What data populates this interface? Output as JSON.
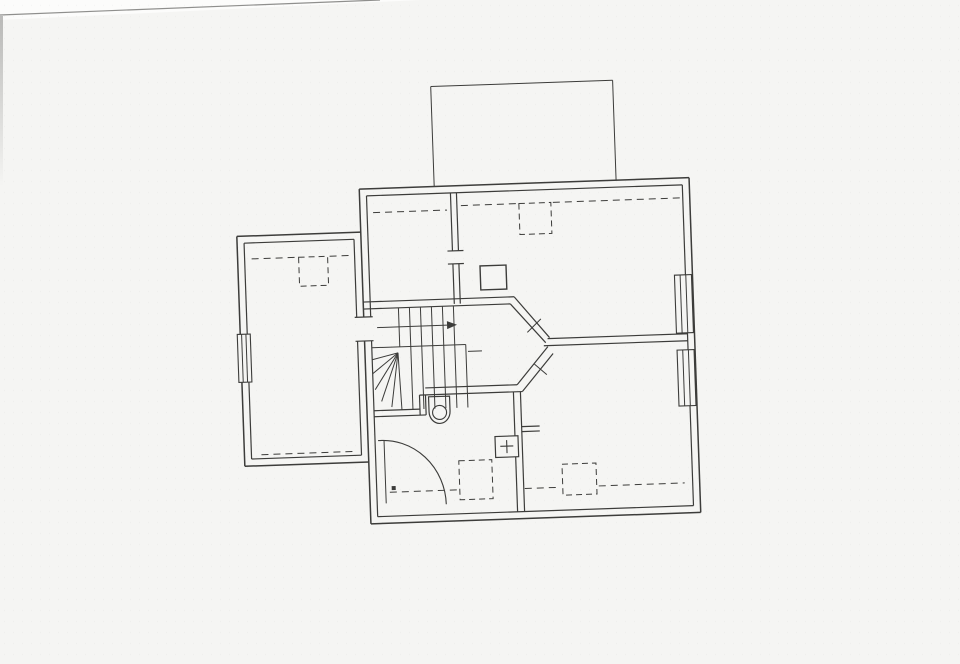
{
  "page": {
    "paper_color": "#f5f5f3",
    "scanner_bg_color": "#fcfcfb",
    "ink_color": "#3c3c3a",
    "text_color": "#2e2e2c",
    "paper_edge_line": [
      0,
      15,
      380,
      0
    ],
    "plan_rotation_deg": -2,
    "plan_rotation_center": [
      480,
      352
    ]
  },
  "plan": {
    "rooms": [
      {
        "number": "7",
        "area": "6.0",
        "x": 494,
        "y": 344
      },
      {
        "number": "8",
        "area": "13.4",
        "x": 590,
        "y": 425
      },
      {
        "number": "9",
        "area": "7.7",
        "x": 446,
        "y": 441
      },
      {
        "number": "10",
        "area": "16.0",
        "x": 311,
        "y": 346
      },
      {
        "number": "11",
        "area": "4.6",
        "x": 416,
        "y": 251
      },
      {
        "number": "12",
        "area": "16.5",
        "x": 578,
        "y": 262
      }
    ],
    "dimension_labels": [
      {
        "t": "0.19",
        "x": 380,
        "y": 207,
        "r": -90
      },
      {
        "t": "h=1.60",
        "x": 413,
        "y": 213,
        "r": 0
      },
      {
        "t": "2.37",
        "x": 387,
        "y": 250,
        "r": -90
      },
      {
        "t": "1.95",
        "x": 419,
        "y": 296,
        "r": 180
      },
      {
        "t": "0.19",
        "x": 461,
        "y": 204,
        "r": -90
      },
      {
        "t": "2.37",
        "x": 460,
        "y": 247,
        "r": -90
      },
      {
        "t": "h=1.60",
        "x": 574,
        "y": 211,
        "r": 0
      },
      {
        "t": "5.42",
        "x": 597,
        "y": 238,
        "r": 180
      },
      {
        "t": "0.19",
        "x": 671,
        "y": 206,
        "r": -75
      },
      {
        "t": "3.52",
        "x": 670,
        "y": 268,
        "r": -90
      },
      {
        "t": "0.57",
        "x": 490,
        "y": 259,
        "r": 180
      },
      {
        "t": "0.58",
        "x": 513,
        "y": 278,
        "r": -90
      },
      {
        "t": "1.45",
        "x": 482,
        "y": 295,
        "r": 180
      },
      {
        "t": "3.97",
        "x": 540,
        "y": 297,
        "r": 180
      },
      {
        "t": "3.45",
        "x": 501,
        "y": 310,
        "r": 180
      },
      {
        "t": "1.43",
        "x": 533,
        "y": 324,
        "r": 135
      },
      {
        "t": "2.30",
        "x": 468,
        "y": 340,
        "r": 180
      },
      {
        "t": "1.13",
        "x": 474,
        "y": 362,
        "r": -90
      },
      {
        "t": "4.40",
        "x": 513,
        "y": 349,
        "r": 135
      },
      {
        "t": "1.42",
        "x": 534,
        "y": 364,
        "r": -135
      },
      {
        "t": "1.48",
        "x": 545,
        "y": 374,
        "r": -135
      },
      {
        "t": "3.45",
        "x": 500,
        "y": 384,
        "r": 180
      },
      {
        "t": "3.02",
        "x": 611,
        "y": 338,
        "r": 180
      },
      {
        "t": "3.02",
        "x": 614,
        "y": 355,
        "r": 180
      },
      {
        "t": "0.90",
        "x": 521,
        "y": 408,
        "r": -90
      },
      {
        "t": "0.10",
        "x": 542,
        "y": 433,
        "r": -90
      },
      {
        "t": "0.62",
        "x": 526,
        "y": 439,
        "r": 180
      },
      {
        "t": "2.35",
        "x": 501,
        "y": 431,
        "r": -90
      },
      {
        "t": "3.97",
        "x": 566,
        "y": 408,
        "r": 180
      },
      {
        "t": "3.52",
        "x": 669,
        "y": 416,
        "r": -75
      },
      {
        "t": "h=1.60",
        "x": 607,
        "y": 484,
        "r": 0
      },
      {
        "t": "0.19",
        "x": 673,
        "y": 494,
        "r": -90
      },
      {
        "t": "0.39",
        "x": 413,
        "y": 401,
        "r": -90
      },
      {
        "t": "0.83",
        "x": 394,
        "y": 417,
        "r": 180
      },
      {
        "t": "3.40",
        "x": 419,
        "y": 432,
        "r": 180
      },
      {
        "t": "h=1.60",
        "x": 443,
        "y": 487,
        "r": 0
      },
      {
        "t": "0.19",
        "x": 498,
        "y": 491,
        "r": -90
      },
      {
        "t": "0.19",
        "x": 250,
        "y": 250,
        "r": -90
      },
      {
        "t": "h=1.60",
        "x": 281,
        "y": 250,
        "r": 180
      },
      {
        "t": "5.28",
        "x": 263,
        "y": 347,
        "r": -80
      },
      {
        "t": "3.03",
        "x": 334,
        "y": 421,
        "r": 180
      },
      {
        "t": "h=1.60",
        "x": 303,
        "y": 447,
        "r": 180
      },
      {
        "t": "0.10",
        "x": 257,
        "y": 446,
        "r": -90
      }
    ],
    "lines": {
      "heavy": [
        [
          365,
          185,
          695,
          185
        ],
        [
          695,
          185,
          695,
          520
        ],
        [
          365,
          520,
          695,
          520
        ],
        [
          365,
          185,
          365,
          313
        ],
        [
          365,
          337,
          365,
          520
        ],
        [
          241,
          228,
          365,
          228
        ],
        [
          241,
          228,
          241,
          326
        ],
        [
          241,
          374,
          241,
          458
        ],
        [
          241,
          458,
          365,
          458
        ]
      ],
      "normal": [
        [
          372,
          192,
          688,
          192
        ],
        [
          688,
          192,
          688,
          513
        ],
        [
          372,
          513,
          688,
          513
        ],
        [
          372,
          192,
          372,
          313
        ],
        [
          372,
          337,
          372,
          513
        ],
        [
          248,
          235,
          358,
          235
        ],
        [
          248,
          235,
          248,
          326
        ],
        [
          248,
          374,
          248,
          451
        ],
        [
          248,
          451,
          358,
          451
        ],
        [
          358,
          235,
          358,
          313
        ],
        [
          358,
          337,
          358,
          451
        ],
        [
          356,
          313,
          374,
          313
        ],
        [
          356,
          337,
          374,
          337
        ],
        [
          456,
          192,
          456,
          250
        ],
        [
          462,
          192,
          462,
          250
        ],
        [
          456,
          263,
          456,
          303
        ],
        [
          462,
          263,
          462,
          303
        ],
        [
          451,
          250,
          467,
          250
        ],
        [
          451,
          263,
          467,
          263
        ],
        [
          365,
          298,
          516,
          298
        ],
        [
          365,
          305,
          512,
          305
        ],
        [
          516,
          298,
          550,
          340
        ],
        [
          512,
          305,
          546,
          345
        ],
        [
          548,
          341,
          688,
          341
        ],
        [
          544,
          348,
          688,
          348
        ],
        [
          548,
          349,
          516,
          386
        ],
        [
          553,
          356,
          521,
          393
        ],
        [
          424,
          386,
          516,
          386
        ],
        [
          418,
          393,
          521,
          393
        ],
        [
          418,
          393,
          418,
          413
        ],
        [
          424,
          393,
          424,
          413
        ],
        [
          372,
          407,
          418,
          407
        ],
        [
          372,
          413,
          424,
          413
        ],
        [
          512,
          393,
          512,
          513
        ],
        [
          519,
          393,
          519,
          513
        ],
        [
          519,
          428,
          537,
          428
        ],
        [
          519,
          433,
          537,
          433
        ]
      ],
      "thin": [
        [
          440,
          85,
          622,
          85
        ],
        [
          440,
          85,
          440,
          185
        ],
        [
          622,
          85,
          622,
          185
        ],
        [
          400,
          305,
          400,
          344
        ],
        [
          411,
          305,
          411,
          344
        ],
        [
          422,
          305,
          422,
          344
        ],
        [
          433,
          305,
          433,
          344
        ],
        [
          444,
          305,
          444,
          344
        ],
        [
          455,
          305,
          455,
          344
        ],
        [
          372,
          344,
          466,
          344
        ],
        [
          466,
          344,
          466,
          407
        ],
        [
          411,
          344,
          411,
          407
        ],
        [
          422,
          344,
          422,
          407
        ],
        [
          433,
          344,
          433,
          407
        ],
        [
          444,
          344,
          444,
          407
        ],
        [
          455,
          344,
          455,
          407
        ],
        [
          398,
          350,
          372,
          356
        ],
        [
          398,
          350,
          372,
          370
        ],
        [
          398,
          350,
          374,
          386
        ],
        [
          398,
          350,
          380,
          398
        ],
        [
          398,
          350,
          390,
          404
        ],
        [
          398,
          350,
          400,
          407
        ],
        [
          378,
          324,
          448,
          324
        ],
        [
          468,
          351,
          482,
          351
        ],
        [
          528,
          334,
          542,
          321
        ],
        [
          534,
          366,
          546,
          377
        ],
        [
          381,
          437,
          381,
          500
        ]
      ]
    },
    "arrow_head": "448,320 458,324 448,328",
    "dashed": {
      "lines": [
        [
          255,
          251,
          300,
          251
        ],
        [
          333,
          251,
          352,
          251
        ],
        [
          258,
          447,
          350,
          447
        ],
        [
          378,
          209,
          452,
          209
        ],
        [
          466,
          205,
          522,
          205
        ],
        [
          558,
          205,
          685,
          205
        ],
        [
          385,
          489,
          453,
          489
        ],
        [
          520,
          490,
          556,
          490
        ],
        [
          594,
          490,
          680,
          490
        ]
      ],
      "rects": [
        [
          302,
          251,
          29,
          29
        ],
        [
          524,
          205,
          32,
          31
        ],
        [
          455,
          460,
          33,
          39
        ],
        [
          558,
          467,
          34,
          31
        ]
      ]
    },
    "windows": [
      {
        "x": 238,
        "y": 326,
        "w": 13,
        "h": 48
      },
      {
        "x": 677,
        "y": 282,
        "w": 17,
        "h": 58
      },
      {
        "x": 677,
        "y": 357,
        "w": 17,
        "h": 56
      }
    ],
    "fixtures": {
      "chimney_rect": [
        483,
        266,
        26,
        24
      ],
      "radiator_rect": [
        492,
        437,
        23,
        21
      ],
      "radiator_plus": [
        [
          497,
          447,
          510,
          447
        ],
        [
          503.5,
          441,
          503.5,
          454
        ]
      ],
      "wc_path": "M427,395 h21 v15 a10.5,12 0 0 1 -21,0 Z",
      "wc_circle": [
        437.5,
        411,
        7
      ],
      "shower_arc": "M375,437 A63,66 0 0 1 441,503",
      "hinge_dot": [
        387,
        483,
        4,
        4
      ]
    }
  }
}
